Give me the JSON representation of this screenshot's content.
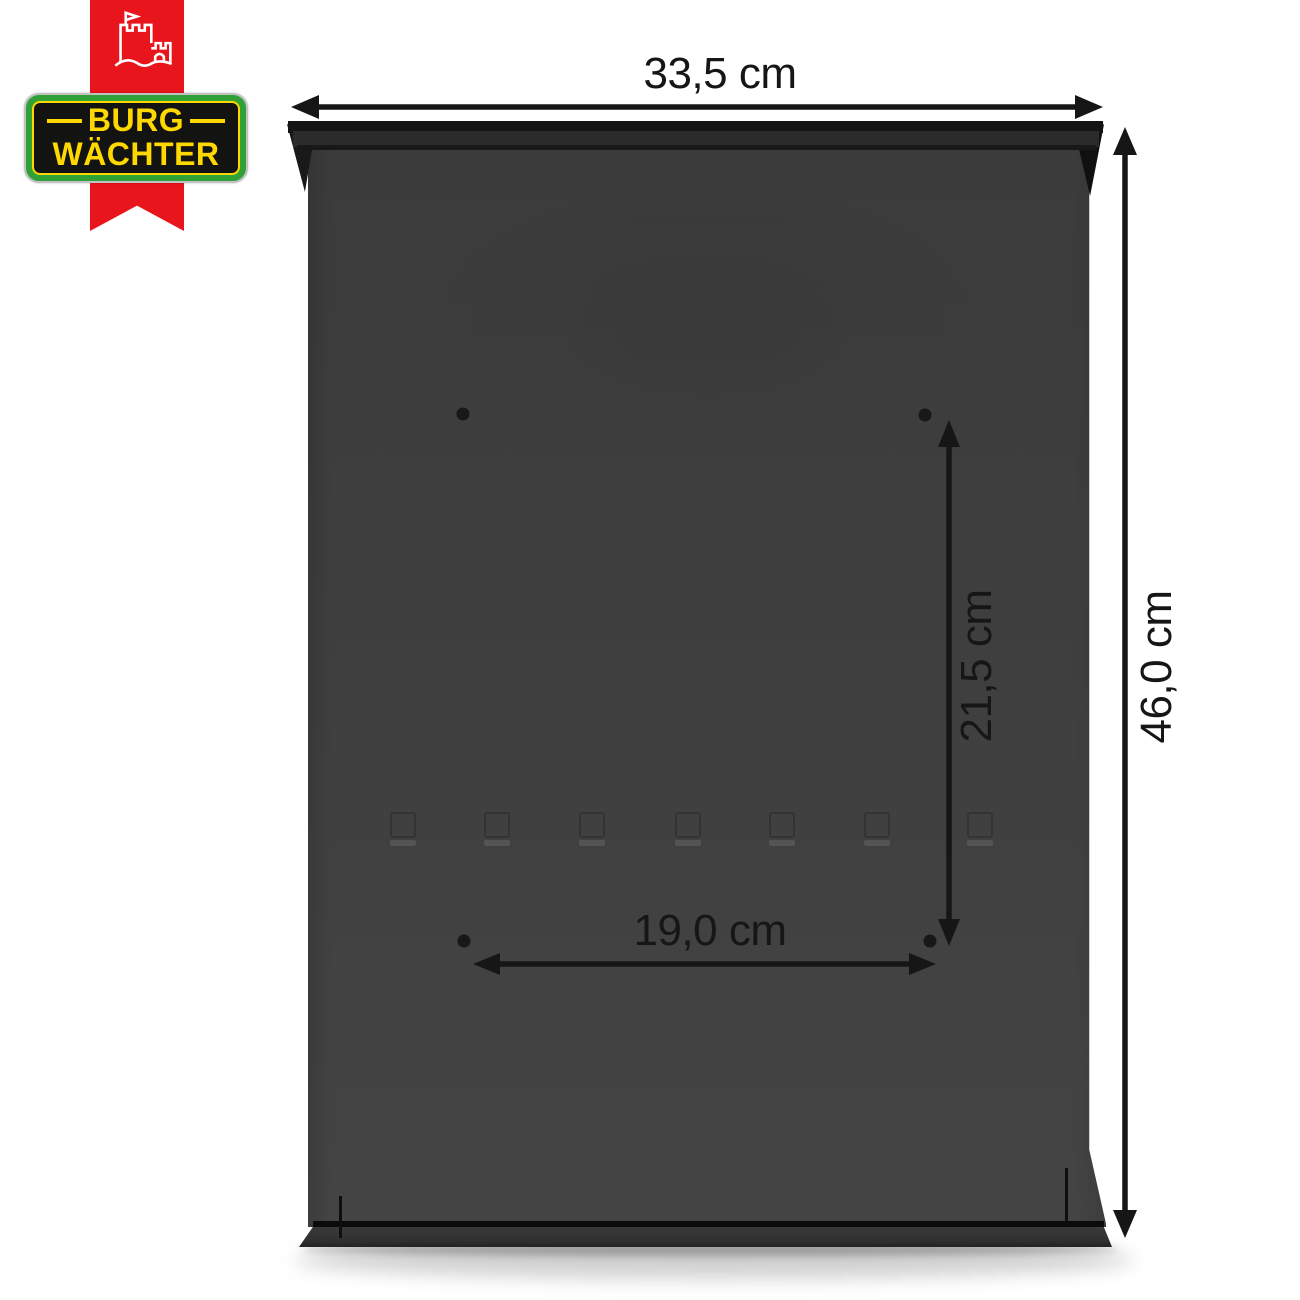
{
  "theme": {
    "page-bg": "#ffffff",
    "ribbon-red": "#e8151d",
    "badge-green": "#2fa136",
    "badge-yellow": "#ffd800",
    "badge-black": "#131311",
    "badge-silver": "#c2c2c2",
    "box-gray": "#3e3e3e",
    "box-dark": "#141414",
    "ink": "#161616"
  },
  "logo": {
    "brand_line1": "BURG",
    "brand_line2": "WÄCHTER",
    "castle_icon": "castle-with-flag-icon"
  },
  "product": {
    "description": "Anthracite letterbox rear view with four mounting holes",
    "mounting_hole_count": 4,
    "body_color": "#3e3e3e"
  },
  "dimensions": {
    "unit": "cm",
    "overall_width": {
      "label": "33,5 cm"
    },
    "overall_height": {
      "label": "46,0 cm"
    },
    "hole_spacing_vertical": {
      "label": "21,5 cm"
    },
    "hole_spacing_horizontal": {
      "label": "19,0 cm"
    }
  }
}
